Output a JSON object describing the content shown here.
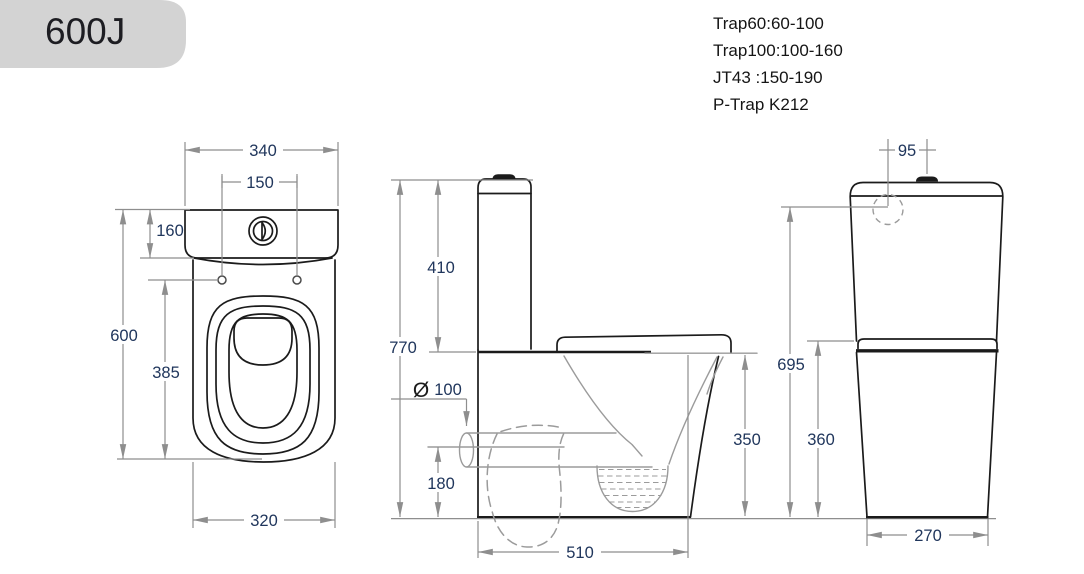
{
  "title": "600J",
  "specs": {
    "lines": [
      "Trap60:60-100",
      "Trap100:100-160",
      "JT43 :150-190",
      "P-Trap K212"
    ]
  },
  "dimensions": {
    "top_view": {
      "cistern_width": "340",
      "fixing_holes_spacing": "150",
      "cistern_depth": "160",
      "overall_length": "600",
      "holes_to_front": "385",
      "pan_width": "320"
    },
    "side_view": {
      "cistern_height": "410",
      "overall_height": "770",
      "outlet_diameter_symbol": "Ø",
      "outlet_diameter": "100",
      "outlet_centre_height": "180",
      "footprint_depth": "510",
      "rim_height": "350"
    },
    "rear_view": {
      "inlet_offset": "95",
      "inlet_height": "695",
      "shelf_height": "360",
      "base_width": "270"
    }
  },
  "colors": {
    "banner": "#d3d3d3",
    "outline": "#1b1b1b",
    "dimension_lines": "#8e8e8e",
    "dimension_text": "#20365c"
  }
}
